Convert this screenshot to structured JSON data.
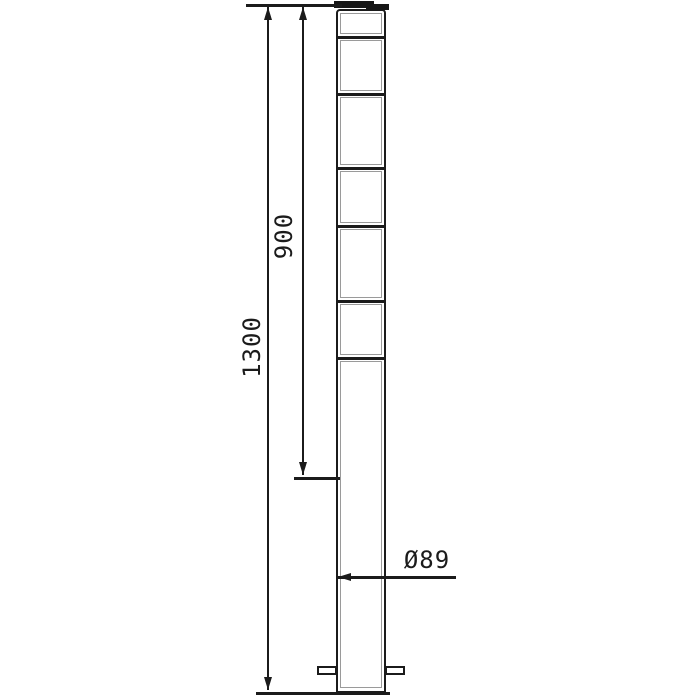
{
  "drawing": {
    "labels": {
      "total_length": "1300",
      "height_above_ground": "900",
      "diameter": "Ø89"
    },
    "colors": {
      "line": "#1b1b1b",
      "inner_line": "#9a9a9a",
      "background": "#ffffff"
    }
  }
}
